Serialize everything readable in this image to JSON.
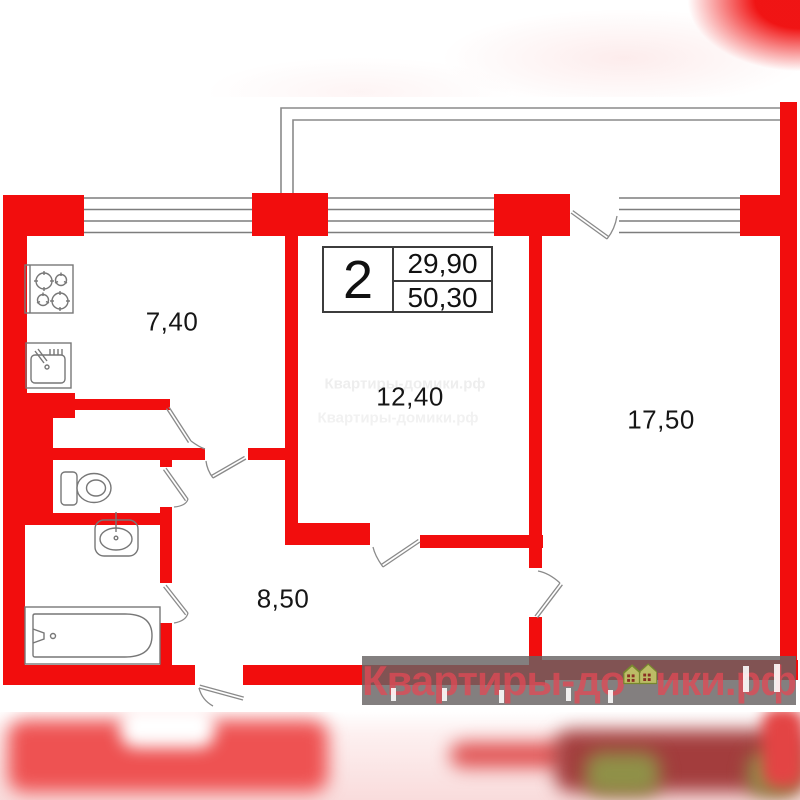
{
  "plan": {
    "type": "apartment floor plan, 2-room flat",
    "rooms": [
      {
        "id": "kitchen",
        "area_label": "7,40"
      },
      {
        "id": "living-room",
        "area_label": "12,40"
      },
      {
        "id": "bedroom",
        "area_label": "17,50"
      },
      {
        "id": "hallway",
        "area_label": "8,50"
      }
    ],
    "info_table": {
      "rooms_count": "2",
      "upper_value": "29,90",
      "lower_value": "50,30"
    },
    "fixtures": [
      "stove-icon",
      "kitchen-sink-icon",
      "toilet-icon",
      "washbasin-icon",
      "bathtub-icon"
    ]
  },
  "watermark": {
    "full_text": "Квартиры-домики.рф",
    "text_left": "Квартиры-до",
    "text_right": "ики.рф",
    "logo": "houses-logo-icon"
  },
  "colors": {
    "wall_red": "#f20d0d",
    "line_gray": "#7d7d7d",
    "label_black": "#161616",
    "watermark_bar": "#686363",
    "watermark_text": "#e34854"
  }
}
